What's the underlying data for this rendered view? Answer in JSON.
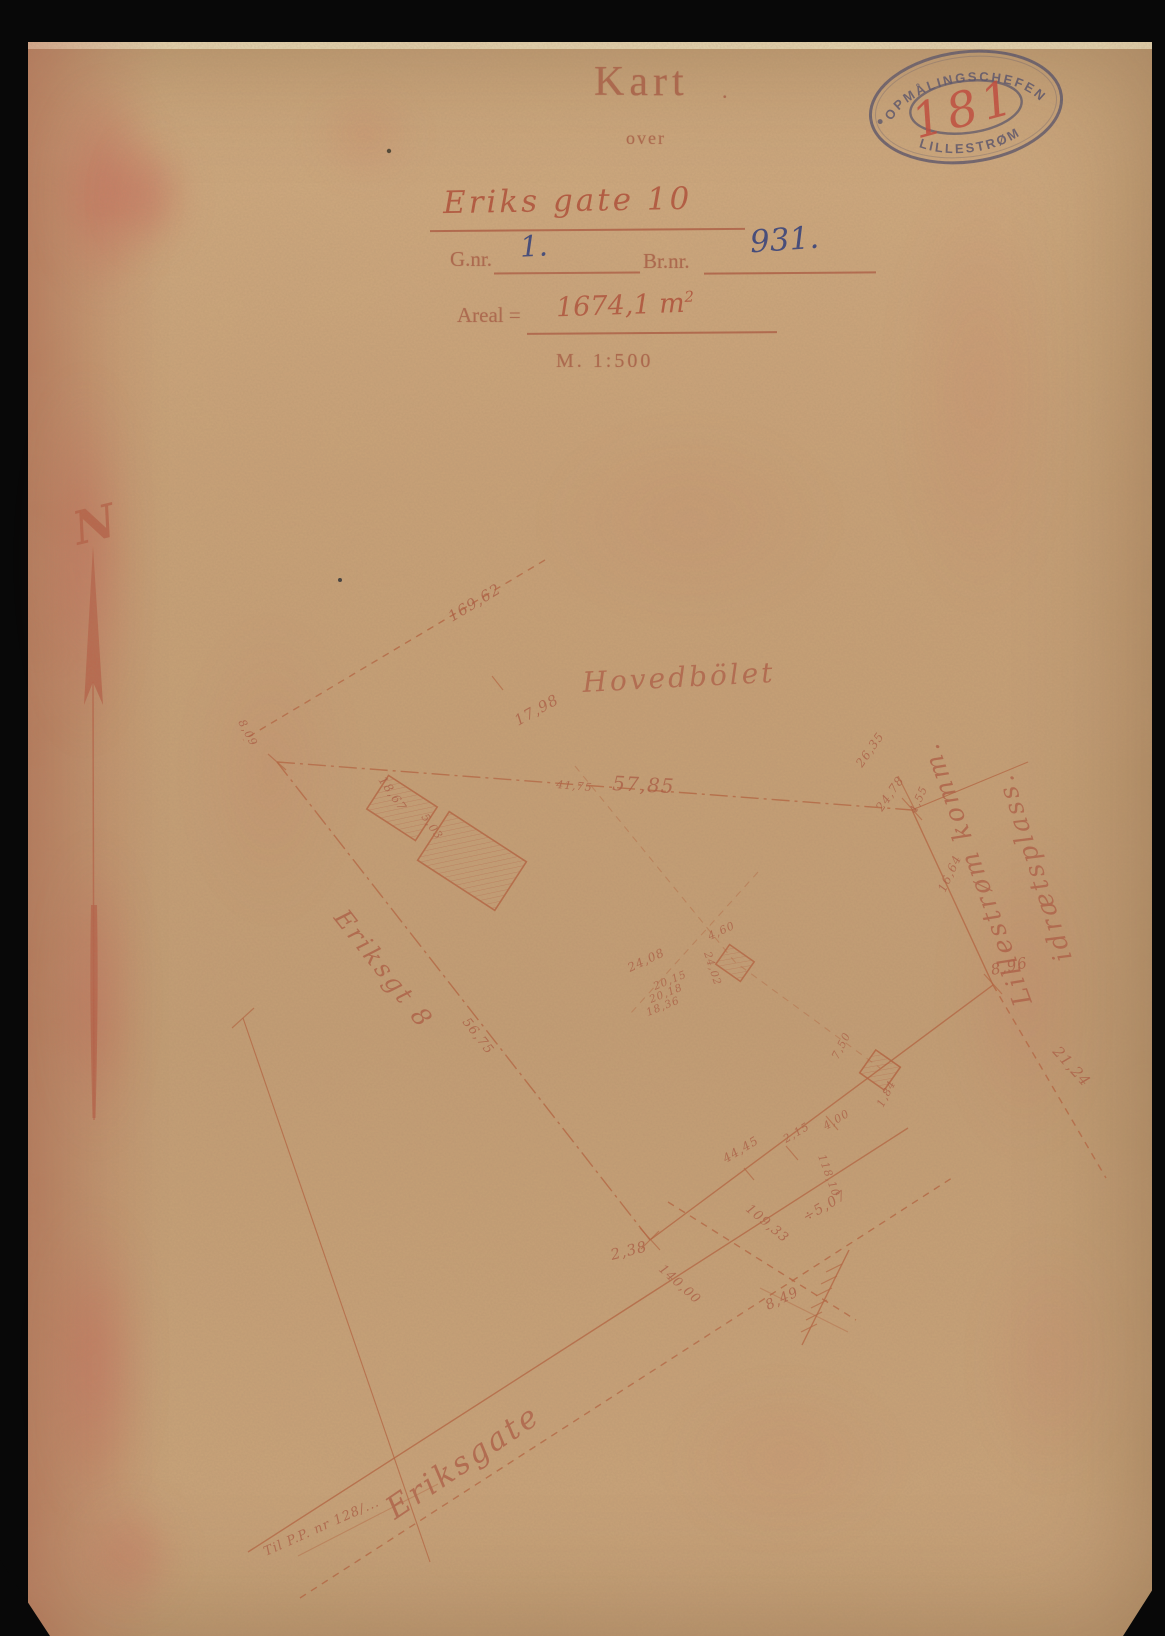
{
  "colors": {
    "paper": "#c7a177",
    "print_ink": "#a85d45",
    "hand_red": "#b1523a",
    "hand_blue": "#2f3e7d",
    "map_ink": "#b4623f",
    "stamp_ink": "#52506a",
    "stamp_number_red": "#c24438"
  },
  "header": {
    "title": "Kart",
    "title_dot": ".",
    "subtitle": "over",
    "street": "Eriks gate 10",
    "gnr_label": "G.nr.",
    "gnr_value": "1.",
    "brnr_label": "Br.nr.",
    "brnr_value": "931.",
    "areal_label": "Areal =",
    "areal_value": "1674,1 m",
    "areal_sup": "2",
    "scale": "M. 1:500"
  },
  "stamp": {
    "arc_top": "OPMÅLINGSCHEFEN",
    "arc_bottom": "LILLESTRØM",
    "number": "181"
  },
  "compass": {
    "label": "N"
  },
  "map": {
    "labels": [
      {
        "text": "169,62",
        "x": 452,
        "y": 622,
        "rot": -31,
        "size": 15,
        "kind": "meas"
      },
      {
        "text": "17,98",
        "x": 518,
        "y": 726,
        "rot": -29,
        "size": 15,
        "kind": "meas"
      },
      {
        "text": "8,09",
        "x": 238,
        "y": 722,
        "rot": 62,
        "size": 11,
        "kind": "meas"
      },
      {
        "text": "Hovedbölet",
        "x": 583,
        "y": 692,
        "rot": -3,
        "size": 28,
        "kind": "name"
      },
      {
        "text": "57,85",
        "x": 612,
        "y": 790,
        "rot": 3,
        "size": 20,
        "kind": "meas"
      },
      {
        "text": "41,75",
        "x": 556,
        "y": 788,
        "rot": 5,
        "size": 11,
        "kind": "meas"
      },
      {
        "text": "18,67",
        "x": 378,
        "y": 780,
        "rot": 55,
        "size": 12,
        "kind": "meas"
      },
      {
        "text": "5,03",
        "x": 421,
        "y": 817,
        "rot": 55,
        "size": 11,
        "kind": "meas"
      },
      {
        "text": "26,35",
        "x": 862,
        "y": 768,
        "rot": -55,
        "size": 12,
        "kind": "meas"
      },
      {
        "text": "24,78",
        "x": 882,
        "y": 812,
        "rot": -55,
        "size": 12,
        "kind": "meas"
      },
      {
        "text": "4,55",
        "x": 916,
        "y": 814,
        "rot": -66,
        "size": 11,
        "kind": "meas"
      },
      {
        "text": "16,64",
        "x": 945,
        "y": 893,
        "rot": -65,
        "size": 12,
        "kind": "meas"
      },
      {
        "text": "8,96",
        "x": 992,
        "y": 975,
        "rot": -12,
        "size": 15,
        "kind": "meas"
      },
      {
        "text": "21,24",
        "x": 1052,
        "y": 1052,
        "rot": 48,
        "size": 15,
        "kind": "meas"
      },
      {
        "text": "Lillestrøm komm.",
        "x": 1032,
        "y": 1002,
        "rot": -110,
        "size": 26,
        "kind": "name"
      },
      {
        "text": "idrætsplass.",
        "x": 1072,
        "y": 958,
        "rot": -108,
        "size": 26,
        "kind": "name"
      },
      {
        "text": "Eriksgt 8",
        "x": 333,
        "y": 918,
        "rot": 52,
        "size": 25,
        "kind": "name"
      },
      {
        "text": "56,75",
        "x": 462,
        "y": 1022,
        "rot": 52,
        "size": 13,
        "kind": "meas"
      },
      {
        "text": "2,38",
        "x": 612,
        "y": 1260,
        "rot": -14,
        "size": 15,
        "kind": "meas"
      },
      {
        "text": "44,45",
        "x": 726,
        "y": 1163,
        "rot": -31,
        "size": 12,
        "kind": "meas"
      },
      {
        "text": "2,15",
        "x": 786,
        "y": 1143,
        "rot": -31,
        "size": 11,
        "kind": "meas"
      },
      {
        "text": "4,00",
        "x": 826,
        "y": 1130,
        "rot": -31,
        "size": 11,
        "kind": "meas"
      },
      {
        "text": "118,10",
        "x": 818,
        "y": 1156,
        "rot": 70,
        "size": 11,
        "kind": "meas"
      },
      {
        "text": "÷5,07",
        "x": 806,
        "y": 1222,
        "rot": -30,
        "size": 14,
        "kind": "meas"
      },
      {
        "text": "109,33",
        "x": 745,
        "y": 1210,
        "rot": 40,
        "size": 13,
        "kind": "meas"
      },
      {
        "text": "140,00",
        "x": 658,
        "y": 1270,
        "rot": 42,
        "size": 13,
        "kind": "meas"
      },
      {
        "text": "8,49",
        "x": 768,
        "y": 1310,
        "rot": -25,
        "size": 14,
        "kind": "meas"
      },
      {
        "text": "24,08",
        "x": 630,
        "y": 972,
        "rot": -25,
        "size": 12,
        "kind": "meas"
      },
      {
        "text": "20,15",
        "x": 655,
        "y": 990,
        "rot": -22,
        "size": 10.5,
        "kind": "meas"
      },
      {
        "text": "20,18",
        "x": 651,
        "y": 1003,
        "rot": -22,
        "size": 10.5,
        "kind": "meas"
      },
      {
        "text": "18,36",
        "x": 648,
        "y": 1016,
        "rot": -22,
        "size": 10.5,
        "kind": "meas"
      },
      {
        "text": "4,60",
        "x": 710,
        "y": 940,
        "rot": -25,
        "size": 11,
        "kind": "meas"
      },
      {
        "text": "24,02",
        "x": 704,
        "y": 953,
        "rot": 72,
        "size": 10.5,
        "kind": "meas"
      },
      {
        "text": "7,50",
        "x": 838,
        "y": 1060,
        "rot": -63,
        "size": 11,
        "kind": "meas"
      },
      {
        "text": "1,84",
        "x": 883,
        "y": 1108,
        "rot": -63,
        "size": 11,
        "kind": "meas"
      },
      {
        "text": "Eriksgate",
        "x": 395,
        "y": 1520,
        "rot": -34,
        "size": 31,
        "kind": "name"
      },
      {
        "text": "Til P.P. nr 128/...",
        "x": 266,
        "y": 1556,
        "rot": -24,
        "size": 13,
        "kind": "meas"
      }
    ]
  }
}
